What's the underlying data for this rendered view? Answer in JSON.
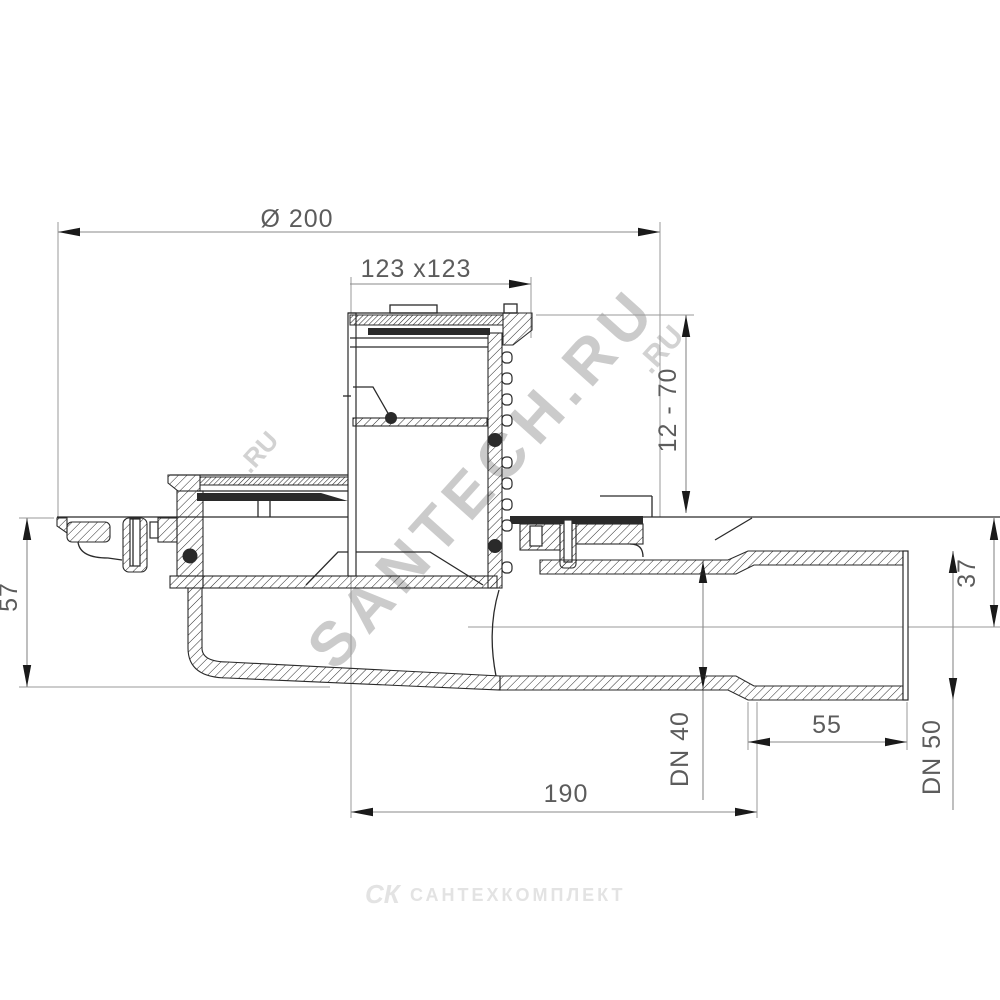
{
  "drawing": {
    "dims": {
      "diameter": "Ø 200",
      "grate": "123 x123",
      "height_adjust": "12 - 70",
      "depth": "57",
      "axis_offset": "37",
      "socket_length": "55",
      "body_length": "190",
      "outlet": "DN 40",
      "socket": "DN 50"
    },
    "watermark": {
      "main": "SANTECH.RU",
      "fragment": ".RU"
    },
    "footer_logo": {
      "icon": "СК",
      "name": "САНТЕХКОМПЛЕКТ"
    },
    "colors": {
      "line": "#2a2a2a",
      "dimension": "#8a8a8a",
      "text": "#5c5c5c",
      "watermark": "#c3c3c3",
      "logo": "#e3e3e3",
      "background": "#ffffff"
    }
  }
}
